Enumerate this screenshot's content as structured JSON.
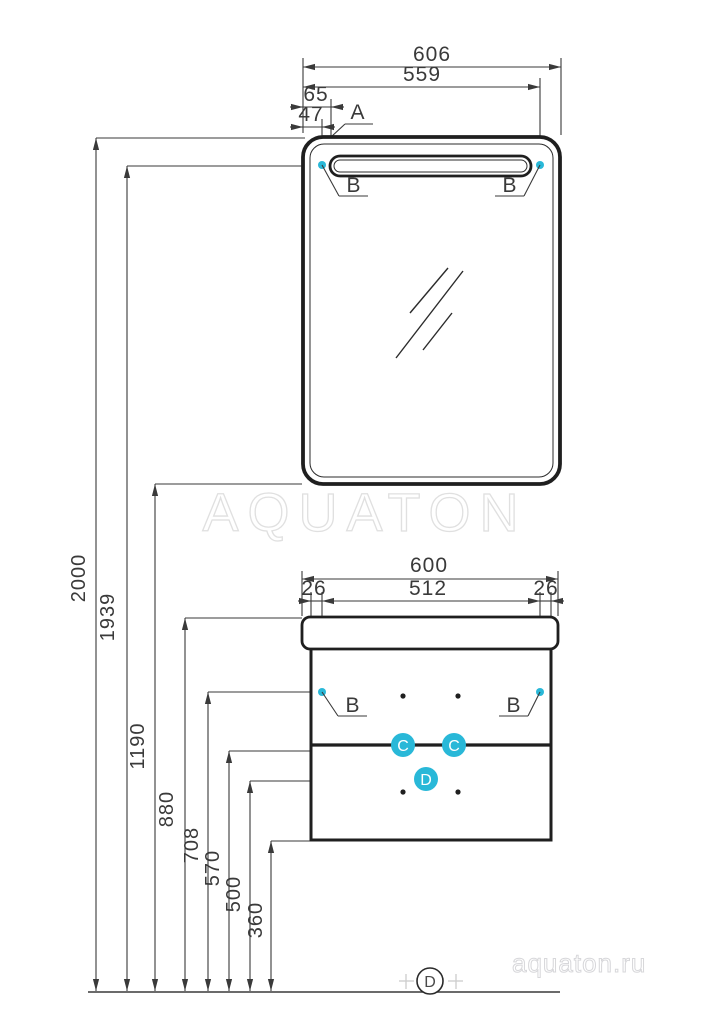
{
  "watermarks": {
    "brand": "AQUATON",
    "site": "aquaton.ru"
  },
  "colors": {
    "accent_cyan": "#29b8d8",
    "line_dark": "#2b2b2b",
    "dim_gray": "#3a3a3a",
    "watermark_gray": "#e0e0e0"
  },
  "mirror": {
    "width": "606",
    "light_span": "559",
    "left_to_light": "65",
    "left_to_fixing": "47",
    "label_a": "A",
    "label_b": "B"
  },
  "cabinet": {
    "width": "600",
    "fixing_span": "512",
    "offset_left": "26",
    "offset_right": "26",
    "label_b": "B",
    "label_c": "C",
    "label_d": "D"
  },
  "heights": {
    "mirror_top": "2000",
    "light": "1939",
    "mirror_bottom": "1190",
    "countertop": "880",
    "cabinet_fixing": "708",
    "drawer_line": "570",
    "point_d": "500",
    "cabinet_bottom": "360"
  },
  "floor_label": "D"
}
